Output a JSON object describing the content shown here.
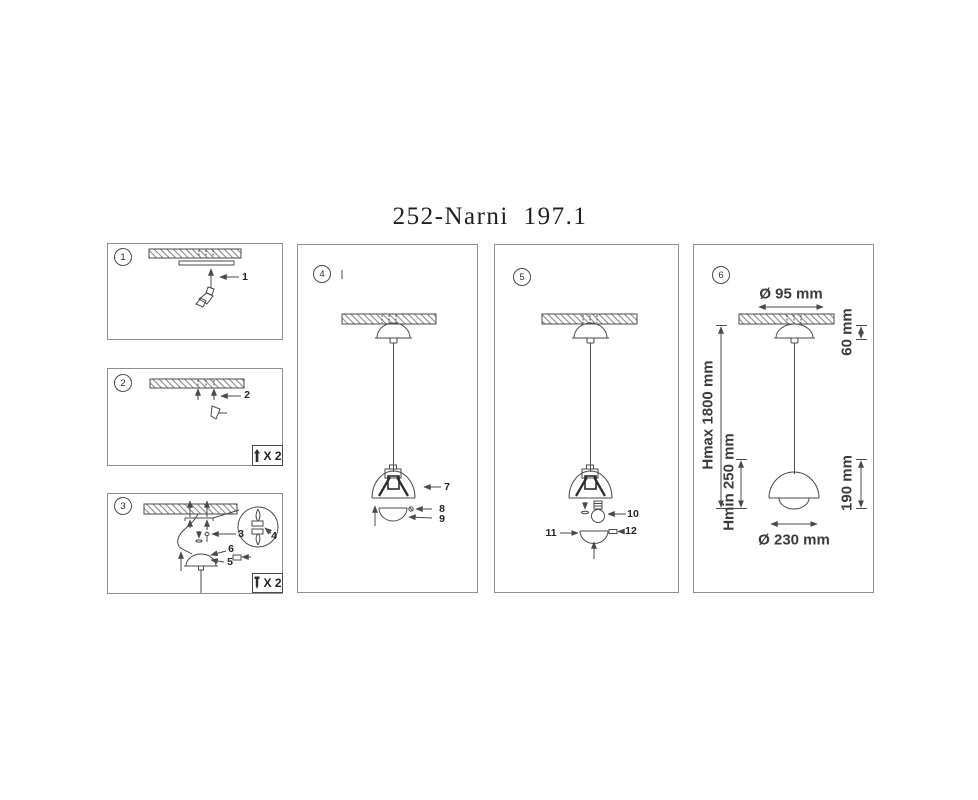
{
  "title": "252-Narni 197.1",
  "colors": {
    "line": "#4a4a4a",
    "text": "#3a3a3a",
    "panel_border": "#8f8f8f",
    "paper": "#ffffff"
  },
  "panels": {
    "step1": {
      "number": "1",
      "parts": {
        "p1": "1"
      }
    },
    "step2": {
      "number": "2",
      "parts": {
        "p2": "2"
      },
      "qty": {
        "icon": "dowel-icon",
        "label": "X 2"
      }
    },
    "step3": {
      "number": "3",
      "parts": {
        "p3": "3",
        "p4": "4",
        "p5": "5",
        "p6": "6"
      },
      "qty": {
        "icon": "screw-icon",
        "label": "X 2"
      }
    },
    "step4": {
      "number": "4",
      "parts": {
        "p7": "7",
        "p8": "8",
        "p9": "9"
      }
    },
    "step5": {
      "number": "5",
      "parts": {
        "p10": "10",
        "p11": "11",
        "p12": "12"
      }
    },
    "step6": {
      "number": "6",
      "dimensions": {
        "canopy_diameter": "Ø 95 mm",
        "canopy_height": "60 mm",
        "height_max": "Hmax 1800 mm",
        "height_min": "Hmin 250 mm",
        "shade_height": "190 mm",
        "shade_diameter": "Ø 230 mm"
      }
    }
  }
}
